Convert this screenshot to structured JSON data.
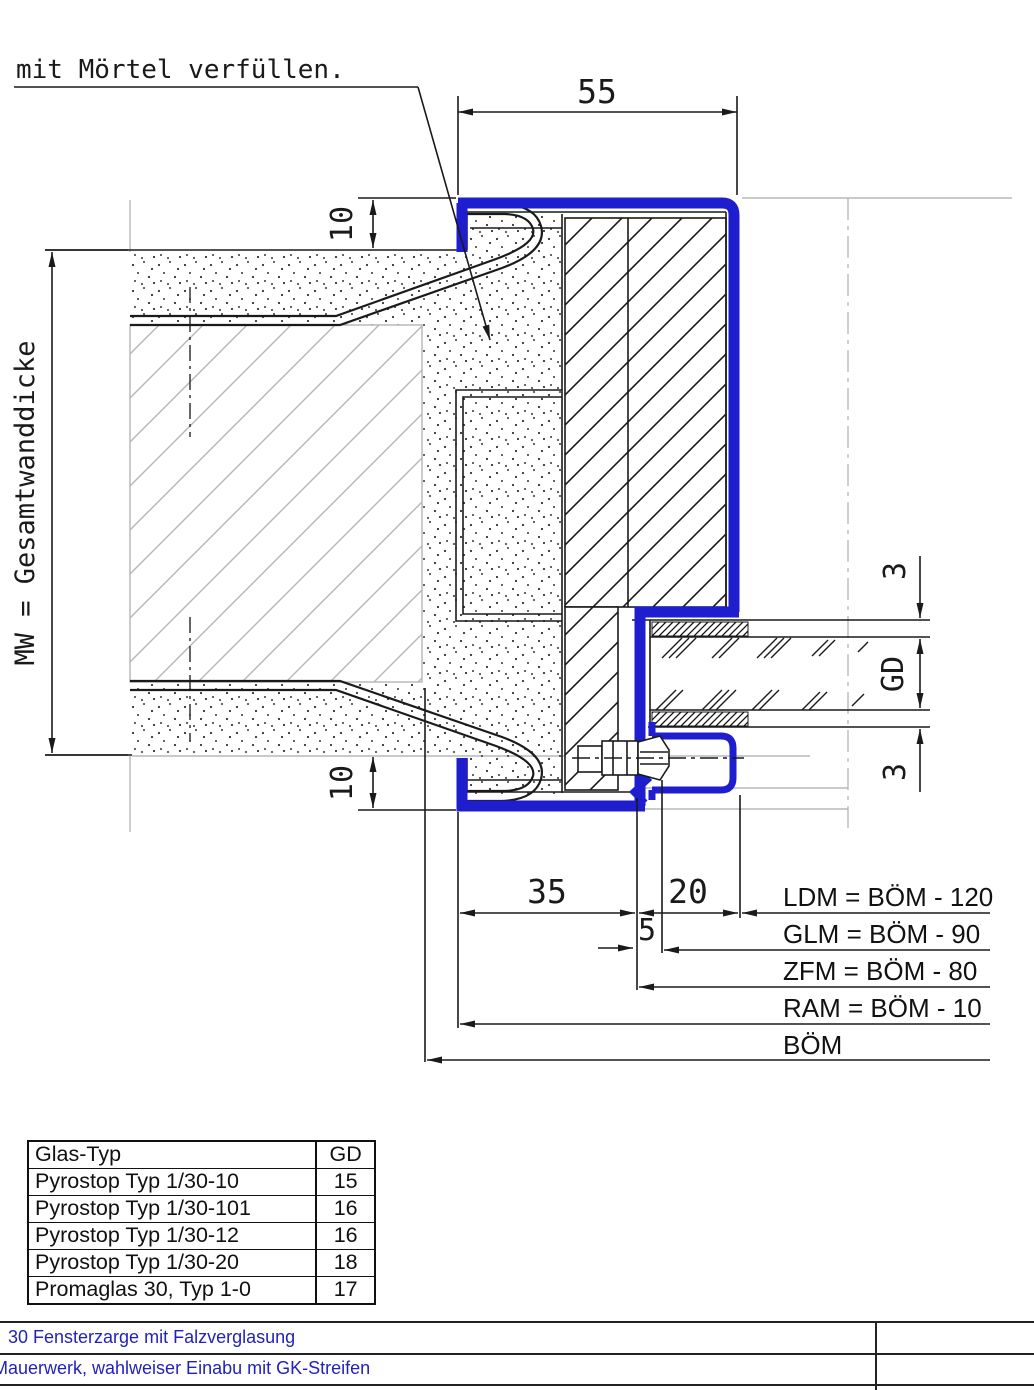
{
  "drawing": {
    "callout": "mit Mörtel verfüllen.",
    "dim_55": "55",
    "dim_10_top": "10",
    "dim_10_bottom": "10",
    "dim_mw": "MW = Gesamtwanddicke",
    "dim_3_top": "3",
    "dim_gd": "GD",
    "dim_3_bottom": "3",
    "dim_35": "35",
    "dim_20": "20",
    "dim_5": "5",
    "labels": {
      "ldm": "LDM = BÖM - 120",
      "glm": "GLM = BÖM - 90",
      "zfm": "ZFM = BÖM - 80",
      "ram": "RAM = BÖM - 10",
      "boem": "BÖM"
    },
    "colors": {
      "frame_blue": "#1e1ecf",
      "line_black": "#1a1a1a",
      "construction_gray": "#b8b8b8",
      "title_blue": "#2222bb"
    }
  },
  "glass_table": {
    "headers": [
      "Glas-Typ",
      "GD"
    ],
    "rows": [
      {
        "type": "Pyrostop Typ 1/30-10",
        "gd": "15"
      },
      {
        "type": "Pyrostop Typ 1/30-101",
        "gd": "16"
      },
      {
        "type": "Pyrostop Typ 1/30-12",
        "gd": "16"
      },
      {
        "type": "Pyrostop Typ 1/30-20",
        "gd": "18"
      },
      {
        "type": "Promaglas 30, Typ 1-0",
        "gd": "17"
      }
    ]
  },
  "title_block": {
    "line1": "30 Fensterzarge mit Falzverglasung",
    "line2": "Mauerwerk, wahlweiser Einabu mit GK-Streifen"
  }
}
